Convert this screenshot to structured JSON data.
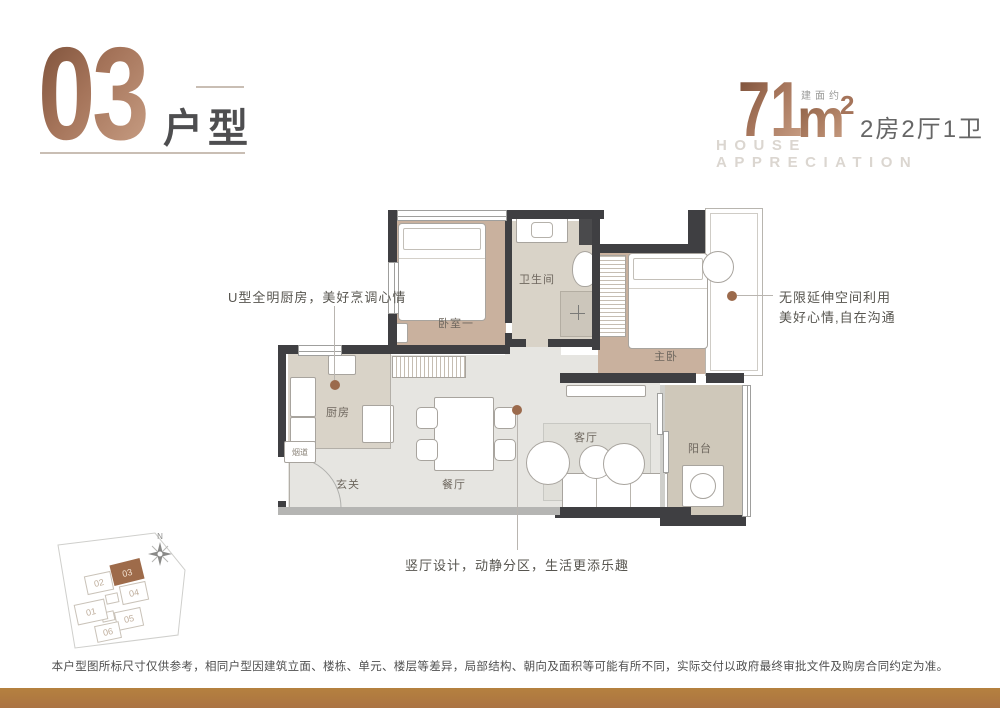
{
  "header": {
    "unit_number": "03",
    "unit_type_label": "户型",
    "area_prefix": "建面约",
    "area_value": "71",
    "area_unit": "m",
    "area_exponent": "2",
    "rooms_summary": "2房2厅1卫",
    "tagline_en": "HOUSE APPRECIATION"
  },
  "floorplan": {
    "rooms": {
      "bedroom1": "卧室一",
      "bathroom": "卫生间",
      "master": "主卧",
      "kitchen": "厨房",
      "flue": "烟道",
      "entry": "玄关",
      "dining": "餐厅",
      "living": "客厅",
      "balcony": "阳台"
    }
  },
  "annotations": {
    "kitchen_note": "U型全明厨房，美好烹调心情",
    "flex_note_line1": "无限延伸空间利用",
    "flex_note_line2": "美好心情,自在沟通",
    "hall_note": "竖厅设计，动静分区，生活更添乐趣"
  },
  "siteplan": {
    "north_label": "N",
    "highlighted": "03",
    "buildings": {
      "b01": "01",
      "b02": "02",
      "b03": "03",
      "b04": "04",
      "b05": "05",
      "b06": "06"
    }
  },
  "footer": {
    "disclaimer": "本户型图所标尺寸仅供参考，相同户型因建筑立面、楼栋、单元、楼层等差异，局部结构、朝向及面积等可能有所不同，实际交付以政府最终审批文件及购房合同约定为准。"
  },
  "colors": {
    "bronze_dark": "#7d513a",
    "bronze_light": "#c79d83",
    "accent_brown": "#9b6a4c",
    "wall_dark": "#3f3f42",
    "floor_beige": "#c9b19e",
    "floor_tile": "#d9d3c8",
    "floor_gray": "#e6e5e1",
    "bottom_bar": "#b17a42"
  }
}
